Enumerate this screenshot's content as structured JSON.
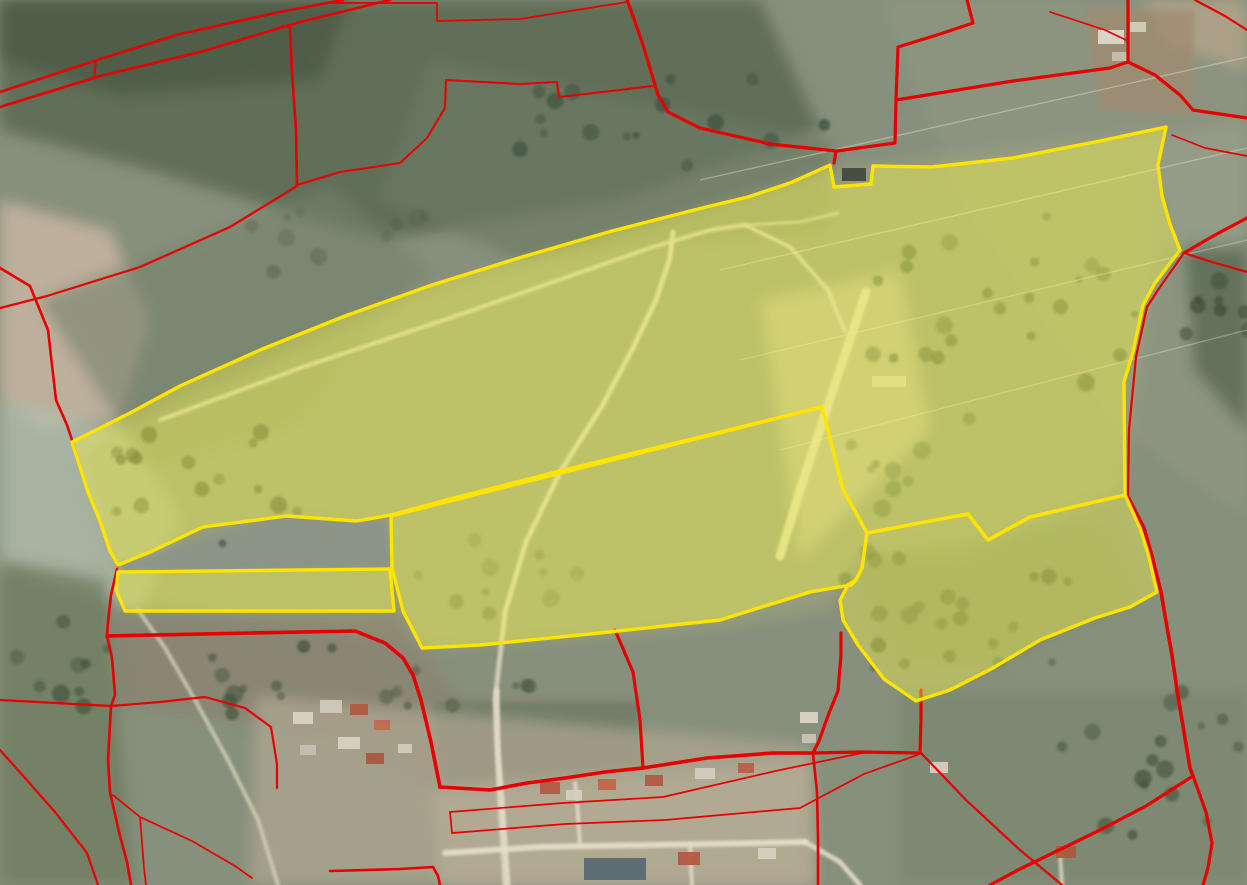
{
  "map": {
    "kind": "aerial-cadastre-view",
    "canvas": {
      "width": 1247,
      "height": 885
    },
    "palette": {
      "base_ground": "#87907c",
      "boundary_red": "#e60000",
      "selection_stroke": "#ffe400",
      "selection_fill": "#ffff45",
      "selection_fill_opacity": 0.38,
      "road_white": "#ddd7c0",
      "woodland_dark": "#4c5a46"
    },
    "background_patches": [
      {
        "name": "nw-dark-band",
        "points": "0,0 760,0 820,130 620,200 380,240 150,170 0,130",
        "color": "#5a6852",
        "opacity": 0.85,
        "blur": "soft"
      },
      {
        "name": "nw-woods-corner",
        "points": "0,0 350,0 320,80 120,95 0,60",
        "color": "#4c5a46",
        "opacity": 0.8,
        "blur": "soft"
      },
      {
        "name": "top-mid-pasture",
        "points": "430,60 830,140 830,230 520,260 380,200",
        "color": "#6e7b64",
        "opacity": 0.7,
        "blur": "soft"
      },
      {
        "name": "pale-pink-left",
        "points": "0,200 110,230 150,320 120,420 40,430 0,400",
        "color": "#c3b3a0",
        "opacity": 0.9,
        "blur": "soft"
      },
      {
        "name": "pale-band-left",
        "points": "0,400 130,430 180,520 140,610 0,570",
        "color": "#b2bdae",
        "opacity": 0.75,
        "blur": "soft"
      },
      {
        "name": "left-green-parcel",
        "points": "40,300 330,185 430,270 300,420 150,470",
        "color": "#75826a",
        "opacity": 0.6,
        "blur": "soft"
      },
      {
        "name": "ne-fields",
        "points": "880,0 1247,0 1247,520 1120,430 960,200",
        "color": "#8d9681",
        "opacity": 0.75,
        "blur": "soft"
      },
      {
        "name": "ne-tan-corner",
        "points": "1140,0 1247,0 1247,70 1170,45",
        "color": "#b4a489",
        "opacity": 0.8,
        "blur": "soft"
      },
      {
        "name": "farm-tan",
        "points": "1085,8 1195,12 1190,115 1100,110",
        "color": "#a08a70",
        "opacity": 0.75,
        "blur": "soft2"
      },
      {
        "name": "right-dark-trees",
        "points": "1185,240 1247,240 1247,430 1195,370",
        "color": "#53634c",
        "opacity": 0.7,
        "blur": "soft"
      },
      {
        "name": "selected-area-wash",
        "points": "80,450 400,300 830,170 1160,130 1160,250 1120,490 960,560 860,560 830,610 700,630 420,650 120,600",
        "color": "#a3a87e",
        "opacity": 0.5,
        "blur": "soft"
      },
      {
        "name": "bright-zone",
        "points": "760,300 900,270 930,430 800,560",
        "color": "#cfc9a0",
        "opacity": 0.55,
        "blur": "soft"
      },
      {
        "name": "wedge-gray",
        "points": "118,563 290,513 385,522 390,568 120,572",
        "color": "#8c9489",
        "opacity": 0.9,
        "blur": "soft2"
      },
      {
        "name": "below-strip-brown",
        "points": "108,618 400,615 425,655 460,700 630,700 643,770 445,790 340,735 120,705",
        "color": "#8a8271",
        "opacity": 0.7,
        "blur": "soft"
      },
      {
        "name": "gray-parcel-village",
        "points": "432,702 638,702 642,768 442,786",
        "color": "#6f7d66",
        "opacity": 0.85,
        "blur": "soft2"
      },
      {
        "name": "village-pale",
        "points": "255,695 810,745 815,885 250,885",
        "color": "#b0a791",
        "opacity": 0.7,
        "blur": "soft"
      },
      {
        "name": "village-pale-south",
        "points": "430,790 810,760 815,885 440,885",
        "color": "#b6ad96",
        "opacity": 0.7,
        "blur": "soft"
      },
      {
        "name": "bottom-right-green",
        "points": "900,690 1247,690 1247,885 900,885",
        "color": "#7b8771",
        "opacity": 0.8,
        "blur": "soft"
      },
      {
        "name": "bottom-left-green",
        "points": "0,560 105,580 135,885 0,885",
        "color": "#6f7d60",
        "opacity": 0.8,
        "blur": "soft"
      },
      {
        "name": "right-lobe-woods",
        "points": "850,560 1100,520 1140,600 990,670 900,660",
        "color": "#7f8a65",
        "opacity": 0.5,
        "blur": "soft"
      },
      {
        "name": "ne-mid-pale",
        "points": "1150,140 1247,120 1247,250 1170,250",
        "color": "#99a28d",
        "opacity": 0.6,
        "blur": "soft"
      }
    ],
    "tree_clusters": [
      {
        "name": "trees-left-parcel",
        "cx": 190,
        "cy": 480,
        "rx": 120,
        "ry": 70,
        "count": 16,
        "seed": 7,
        "color": "#44543f",
        "opacity": 0.75
      },
      {
        "name": "trees-top-woods",
        "cx": 640,
        "cy": 120,
        "rx": 190,
        "ry": 55,
        "count": 16,
        "seed": 11,
        "color": "#3f5340",
        "opacity": 0.8
      },
      {
        "name": "trees-diagonal-band",
        "cx": 1000,
        "cy": 310,
        "rx": 140,
        "ry": 130,
        "count": 24,
        "seed": 23,
        "color": "#4c5e43",
        "opacity": 0.7
      },
      {
        "name": "trees-right-lobe",
        "cx": 955,
        "cy": 610,
        "rx": 140,
        "ry": 75,
        "count": 22,
        "seed": 31,
        "color": "#49593f",
        "opacity": 0.75
      },
      {
        "name": "trees-bottom-right",
        "cx": 1150,
        "cy": 760,
        "rx": 90,
        "ry": 80,
        "count": 16,
        "seed": 43,
        "color": "#45553e",
        "opacity": 0.75
      },
      {
        "name": "trees-middle-parcel",
        "cx": 480,
        "cy": 570,
        "rx": 110,
        "ry": 45,
        "count": 10,
        "seed": 53,
        "color": "#5a6a4c",
        "opacity": 0.6
      },
      {
        "name": "trees-bottom-left-road",
        "cx": 265,
        "cy": 665,
        "rx": 85,
        "ry": 55,
        "count": 10,
        "seed": 61,
        "color": "#41523c",
        "opacity": 0.75
      },
      {
        "name": "trees-left-edge",
        "cx": 60,
        "cy": 650,
        "rx": 55,
        "ry": 90,
        "count": 9,
        "seed": 71,
        "color": "#44543d",
        "opacity": 0.7
      },
      {
        "name": "trees-above-village",
        "cx": 470,
        "cy": 690,
        "rx": 100,
        "ry": 26,
        "count": 8,
        "seed": 83,
        "color": "#4a5a42",
        "opacity": 0.7
      },
      {
        "name": "trees-right-edge",
        "cx": 1210,
        "cy": 320,
        "rx": 40,
        "ry": 60,
        "count": 8,
        "seed": 97,
        "color": "#3f4f3a",
        "opacity": 0.75
      },
      {
        "name": "trees-nw-scatter",
        "cx": 340,
        "cy": 250,
        "rx": 120,
        "ry": 50,
        "count": 10,
        "seed": 101,
        "color": "#51614b",
        "opacity": 0.5
      },
      {
        "name": "trees-lobe-top",
        "cx": 870,
        "cy": 470,
        "rx": 60,
        "ry": 40,
        "count": 8,
        "seed": 113,
        "color": "#55684a",
        "opacity": 0.6
      }
    ],
    "roads": [
      {
        "name": "upper-track",
        "points": "160,420 300,368 450,318 570,276 650,248 710,230 745,225 790,247 828,290 845,332",
        "width": 4,
        "color": "#d9d4bd",
        "opacity": 0.85
      },
      {
        "name": "upper-track-branch",
        "points": "745,225 800,222 838,213",
        "width": 3,
        "color": "#d9d4bd",
        "opacity": 0.7
      },
      {
        "name": "stripped-field",
        "points": "866,292 833,390 800,490 780,556",
        "width": 9,
        "color": "#dfd9ae",
        "opacity": 0.9
      },
      {
        "name": "middle-road",
        "points": "505,885 499,790 495,700 505,612 526,542 560,472 602,406 633,348 656,300 670,258 673,232",
        "width": 5,
        "color": "#d9d4bd",
        "opacity": 0.9
      },
      {
        "name": "village-road-horizontal",
        "points": "445,853 540,847 650,845 760,843 805,842",
        "width": 6,
        "color": "#e3dcc8",
        "opacity": 0.95
      },
      {
        "name": "village-road-se",
        "points": "805,842 840,862 860,885",
        "width": 5,
        "color": "#e3dcc8",
        "opacity": 0.9
      },
      {
        "name": "village-road-vertical",
        "points": "497,690 498,750 502,800 505,843 508,885",
        "width": 5,
        "color": "#e3dcc8",
        "opacity": 0.9
      },
      {
        "name": "village-branch",
        "points": "580,845 577,800 575,783",
        "width": 4,
        "color": "#e3dcc8",
        "opacity": 0.85
      },
      {
        "name": "village-branch-2",
        "points": "690,845 692,885",
        "width": 4,
        "color": "#e3dcc8",
        "opacity": 0.85
      },
      {
        "name": "village-branch-3",
        "points": "1060,852 1062,885",
        "width": 4,
        "color": "#e3dcc8",
        "opacity": 0.8
      },
      {
        "name": "left-road",
        "points": "138,610 165,648 195,700 228,760 258,820 278,885",
        "width": 4,
        "color": "#d6d0ba",
        "opacity": 0.8
      }
    ],
    "power_lines": [
      {
        "points": "700,180 1247,57",
        "width": 1.4,
        "opacity": 0.4
      },
      {
        "points": "720,270 1247,148",
        "width": 1.4,
        "opacity": 0.4
      },
      {
        "points": "740,360 1247,240",
        "width": 1.4,
        "opacity": 0.35
      },
      {
        "points": "780,450 1247,330",
        "width": 1.4,
        "opacity": 0.35
      }
    ],
    "buildings": [
      {
        "x": 1098,
        "y": 30,
        "w": 26,
        "h": 14,
        "color": "#ded8ca"
      },
      {
        "x": 1130,
        "y": 22,
        "w": 16,
        "h": 10,
        "color": "#d2ccbc"
      },
      {
        "x": 1112,
        "y": 52,
        "w": 15,
        "h": 9,
        "color": "#c6c0b0"
      },
      {
        "x": 842,
        "y": 168,
        "w": 24,
        "h": 13,
        "color": "#454a3e"
      },
      {
        "x": 872,
        "y": 376,
        "w": 34,
        "h": 11,
        "color": "#d3cda6"
      },
      {
        "x": 293,
        "y": 712,
        "w": 20,
        "h": 12,
        "color": "#d9d3c5"
      },
      {
        "x": 320,
        "y": 700,
        "w": 22,
        "h": 13,
        "color": "#cfc9bb"
      },
      {
        "x": 350,
        "y": 704,
        "w": 18,
        "h": 11,
        "color": "#b25a42"
      },
      {
        "x": 374,
        "y": 720,
        "w": 16,
        "h": 10,
        "color": "#c06a50"
      },
      {
        "x": 338,
        "y": 737,
        "w": 22,
        "h": 12,
        "color": "#d9d2c2"
      },
      {
        "x": 366,
        "y": 753,
        "w": 18,
        "h": 11,
        "color": "#ad5640"
      },
      {
        "x": 398,
        "y": 744,
        "w": 14,
        "h": 9,
        "color": "#d3cabb"
      },
      {
        "x": 300,
        "y": 745,
        "w": 16,
        "h": 10,
        "color": "#c7c0b2"
      },
      {
        "x": 540,
        "y": 782,
        "w": 20,
        "h": 12,
        "color": "#b25a42"
      },
      {
        "x": 566,
        "y": 790,
        "w": 16,
        "h": 10,
        "color": "#d6cec0"
      },
      {
        "x": 598,
        "y": 779,
        "w": 18,
        "h": 11,
        "color": "#c2654a"
      },
      {
        "x": 645,
        "y": 775,
        "w": 18,
        "h": 11,
        "color": "#b25a42"
      },
      {
        "x": 695,
        "y": 768,
        "w": 20,
        "h": 11,
        "color": "#d3ccbe"
      },
      {
        "x": 738,
        "y": 763,
        "w": 16,
        "h": 10,
        "color": "#b8604a"
      },
      {
        "x": 800,
        "y": 712,
        "w": 18,
        "h": 11,
        "color": "#dad4c6"
      },
      {
        "x": 802,
        "y": 734,
        "w": 14,
        "h": 9,
        "color": "#c9c3b5"
      },
      {
        "x": 584,
        "y": 858,
        "w": 62,
        "h": 22,
        "color": "#5b6a74"
      },
      {
        "x": 678,
        "y": 852,
        "w": 22,
        "h": 13,
        "color": "#b25a42"
      },
      {
        "x": 758,
        "y": 848,
        "w": 18,
        "h": 11,
        "color": "#d6d0c2"
      },
      {
        "x": 1056,
        "y": 846,
        "w": 20,
        "h": 12,
        "color": "#ad5a40"
      },
      {
        "x": 930,
        "y": 762,
        "w": 18,
        "h": 11,
        "color": "#d5cfc0"
      }
    ],
    "boundaries": {
      "color": "#e60000",
      "lines": [
        {
          "name": "nw-band-upper",
          "points": "0,92 97,60 180,34 280,12 343,0",
          "width": 2.6
        },
        {
          "name": "nw-band-lower",
          "points": "0,107 100,76 200,52 300,22 390,0",
          "width": 2.6
        },
        {
          "name": "nw-band-connector",
          "points": "96,60 94,79",
          "width": 2
        },
        {
          "name": "nw-parcel-east",
          "points": "283,26 290,26 292,72 296,130 297,185",
          "width": 2.6
        },
        {
          "name": "nw-stepped-line",
          "points": "297,185 340,172 400,163 427,138 445,108 446,80 520,84 557,82 559,97 620,90 652,86",
          "width": 2
        },
        {
          "name": "top-thin-step",
          "points": "330,3 437,3 437,21 520,19 627,2",
          "width": 1.7
        },
        {
          "name": "top-vertical-to-notch",
          "points": "627,0 633,16 643,45 652,75 658,95 668,112 700,128 770,144 836,151 834,163",
          "width": 3.2
        },
        {
          "name": "notch-north-boundary",
          "points": "967,0 973,23 940,34 898,47 896,100 895,143 837,151",
          "width": 3.2
        },
        {
          "name": "ne-heavy-east",
          "points": "896,100 1013,81 1110,68 1128,62",
          "width": 3.2
        },
        {
          "name": "ne-vertical",
          "points": "1128,0 1128,62",
          "width": 3.2
        },
        {
          "name": "ne-farm-bulge",
          "points": "1128,62 1155,75 1180,95 1193,110 1247,118",
          "width": 3.2
        },
        {
          "name": "ne-thin-east",
          "points": "1172,135 1205,148 1247,156",
          "width": 1.7
        },
        {
          "name": "right-edge-junction-a",
          "points": "1247,218 1215,235 1184,253",
          "width": 3.2
        },
        {
          "name": "right-edge-junction-b",
          "points": "1247,272 1212,262 1184,253",
          "width": 2.2
        },
        {
          "name": "red-beside-selection-right",
          "points": "1184,253 1160,287 1147,307 1136,357 1129,430 1128,497",
          "width": 2.2
        },
        {
          "name": "right-lobe-east-red",
          "points": "1128,497 1144,528 1152,556 1161,592 1167,627 1172,655 1177,690 1190,768 1193,776",
          "width": 3.6
        },
        {
          "name": "bottom-right-curve",
          "points": "1193,776 1206,812 1212,843 1208,868 1203,885",
          "width": 3.2
        },
        {
          "name": "bottom-right-diagonal",
          "points": "1193,776 1146,806 1100,830 1018,870 990,885",
          "width": 3.2
        },
        {
          "name": "ne-corner-thin",
          "points": "1050,12 1105,30 1126,40",
          "width": 1.7
        },
        {
          "name": "ne-corner-line",
          "points": "1195,0 1225,16 1247,30",
          "width": 2.2
        },
        {
          "name": "west-boundary",
          "points": "0,268 30,286 48,330 56,400 67,425 73,443 88,492 100,521 110,551 118,566",
          "width": 2.6
        },
        {
          "name": "west-diagonal",
          "points": "297,186 230,227 140,267 47,296 0,308",
          "width": 2.2
        },
        {
          "name": "pinch-south",
          "points": "117,569 111,595 108,622 107,636",
          "width": 2.6
        },
        {
          "name": "below-strip-heavy",
          "points": "107,636 250,633 355,631 385,643 403,658 413,675 421,700 431,742 440,787",
          "width": 3.6
        },
        {
          "name": "left-junction-drop",
          "points": "107,636 112,658 115,695 111,706",
          "width": 2.6
        },
        {
          "name": "left-horizontal",
          "points": "111,706 0,700",
          "width": 2.2
        },
        {
          "name": "left-vertical-south",
          "points": "111,706 108,760 110,792 119,832 127,862 131,885",
          "width": 2.6
        },
        {
          "name": "sw-diagonal",
          "points": "0,750 25,778 55,812 87,853 98,885",
          "width": 2.2
        },
        {
          "name": "village-west-block",
          "points": "111,706 160,702 205,697 245,708 271,727 277,764 277,788",
          "width": 2.2
        },
        {
          "name": "sw-thin-a",
          "points": "113,795 140,817 144,868 146,885",
          "width": 1.7
        },
        {
          "name": "sw-thin-b",
          "points": "140,817 192,841 235,866 252,878",
          "width": 1.7
        },
        {
          "name": "village-south-line",
          "points": "330,871 400,869 433,867 438,876 440,885",
          "width": 2.6
        },
        {
          "name": "village-north-heavy",
          "points": "440,787 490,790 527,783 565,778 605,772 643,768",
          "width": 3.6
        },
        {
          "name": "village-vertical",
          "points": "615,630 633,672 640,720 643,768",
          "width": 3.2
        },
        {
          "name": "village-heavy-east",
          "points": "643,768 707,758 773,753 813,753",
          "width": 3.6
        },
        {
          "name": "village-corner-block",
          "points": "813,753 862,752 920,753 921,718 921,690",
          "width": 3.2
        },
        {
          "name": "village-corner-drop",
          "points": "813,753 817,792 818,838 818,885",
          "width": 2.6
        },
        {
          "name": "lobe-west-red",
          "points": "813,753 819,741 829,713 838,691 841,655 841,633",
          "width": 3.2
        },
        {
          "name": "village-strip-upper",
          "points": "450,812 563,803 663,797 780,770 862,753",
          "width": 1.7
        },
        {
          "name": "village-strip-lower",
          "points": "452,833 565,824 665,820 800,808 864,774 920,754",
          "width": 1.7
        },
        {
          "name": "village-strip-end",
          "points": "450,812 452,833",
          "width": 1.7
        },
        {
          "name": "bottom-center-diagonal",
          "points": "921,753 966,800 1020,850 1062,885",
          "width": 2.2
        }
      ]
    },
    "selected_parcels": {
      "fill": "#ffff45",
      "fill_opacity": 0.38,
      "stroke": "#ffe400",
      "stroke_width": 3.4,
      "polygons": [
        {
          "name": "selected-parcel-upper",
          "points": "72,442 130,413 180,386 260,350 345,316 432,285 522,257 612,231 702,208 748,197 790,183 830,165 834,187 871,184 873,166 932,167 1013,158 1100,141 1166,127 1158,165 1162,196 1170,224 1180,250 1155,283 1143,305 1133,352 1124,382 1125,495 1090,503 1030,517 988,540 968,514 930,521 867,533 843,489 822,407 700,437 560,471 450,499 391,515 357,521 287,516 203,527 150,552 118,565 110,551 100,521 88,492"
        },
        {
          "name": "selected-parcel-middle",
          "points": "391,516 822,407 843,489 867,533 862,568 856,580 851,585 810,592 720,620 600,633 480,645 422,648 403,611 392,568"
        },
        {
          "name": "selected-parcel-strip",
          "points": "118,572 390,569 394,611 125,611 116,590"
        },
        {
          "name": "selected-parcel-east-lobe",
          "points": "867,533 930,521 968,514 988,540 1030,517 1090,503 1125,495 1140,528 1148,553 1157,592 1130,607 1095,618 1040,640 993,668 950,690 916,701 884,679 858,645 843,620 840,600 848,585 856,580 862,568"
        }
      ]
    }
  }
}
